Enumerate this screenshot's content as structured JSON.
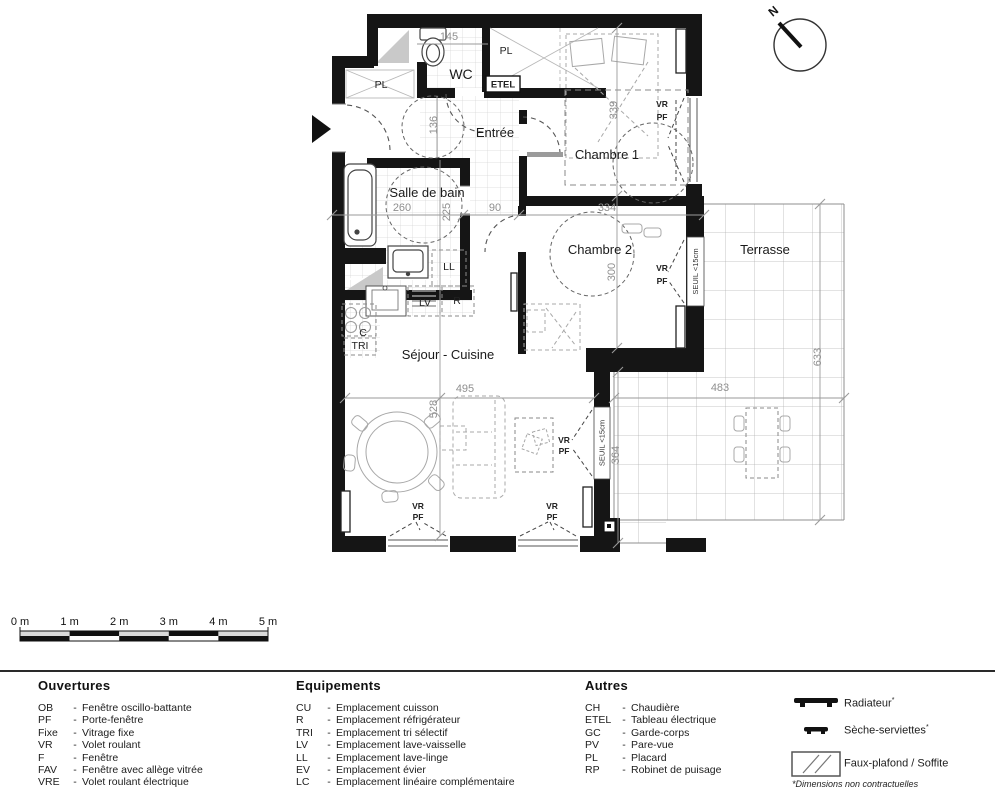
{
  "rooms": {
    "entree": "Entrée",
    "chambre1": "Chambre 1",
    "chambre2": "Chambre 2",
    "salle_de_bain": "Salle de bain",
    "wc": "WC",
    "sejour": "Séjour - Cuisine",
    "terrasse": "Terrasse"
  },
  "dims": {
    "wc_w": "145",
    "entree_w": "136",
    "bain_w": "260",
    "bain_h": "225",
    "hall_w": "90",
    "ch2_w": "334",
    "ch1_h": "339",
    "ch2_h": "300",
    "sejour_w": "495",
    "sejour_h": "528",
    "terrasse_low_w": "483",
    "terrasse_low_h": "364",
    "terrasse_h": "633"
  },
  "marks": {
    "north": "N",
    "pl": "PL",
    "etel": "ETEL",
    "ll": "LL",
    "lv": "LV",
    "r": "R",
    "c": "C",
    "tri": "TRI",
    "vr": "VR",
    "pf": "PF",
    "seuil": "SEUIL <15cm"
  },
  "scale": {
    "labels": [
      "0 m",
      "1 m",
      "2 m",
      "3 m",
      "4 m",
      "5 m"
    ]
  },
  "legend": {
    "sep": "-",
    "ouvertures": {
      "title": "Ouvertures",
      "items": [
        {
          "abbr": "OB",
          "label": "Fenêtre oscillo-battante"
        },
        {
          "abbr": "PF",
          "label": "Porte-fenêtre"
        },
        {
          "abbr": "Fixe",
          "label": "Vitrage fixe"
        },
        {
          "abbr": "VR",
          "label": "Volet roulant"
        },
        {
          "abbr": "F",
          "label": "Fenêtre"
        },
        {
          "abbr": "FAV",
          "label": "Fenêtre avec allège vitrée"
        },
        {
          "abbr": "VRE",
          "label": "Volet roulant électrique"
        }
      ]
    },
    "equipements": {
      "title": "Equipements",
      "items": [
        {
          "abbr": "CU",
          "label": "Emplacement cuisson"
        },
        {
          "abbr": "R",
          "label": "Emplacement réfrigérateur"
        },
        {
          "abbr": "TRI",
          "label": "Emplacement tri sélectif"
        },
        {
          "abbr": "LV",
          "label": "Emplacement lave-vaisselle"
        },
        {
          "abbr": "LL",
          "label": "Emplacement lave-linge"
        },
        {
          "abbr": "EV",
          "label": "Emplacement évier"
        },
        {
          "abbr": "LC",
          "label": "Emplacement linéaire complémentaire"
        }
      ]
    },
    "autres": {
      "title": "Autres",
      "items": [
        {
          "abbr": "CH",
          "label": "Chaudière"
        },
        {
          "abbr": "ETEL",
          "label": "Tableau électrique"
        },
        {
          "abbr": "GC",
          "label": "Garde-corps"
        },
        {
          "abbr": "PV",
          "label": "Pare-vue"
        },
        {
          "abbr": "PL",
          "label": "Placard"
        },
        {
          "abbr": "RP",
          "label": "Robinet de puisage"
        }
      ]
    },
    "symbols": [
      {
        "name": "radiateur",
        "label": "Radiateur",
        "mark": "*"
      },
      {
        "name": "seche-serviettes",
        "label": "Sèche-serviettes",
        "mark": "*"
      },
      {
        "name": "faux-plafond",
        "label": "Faux-plafond / Soffite",
        "mark": ""
      }
    ],
    "footnote": "*Dimensions non contractuelles"
  },
  "colors": {
    "wall": "#151515",
    "dim": "#8f8f8f",
    "grid": "#d2d2d2",
    "terrace_grid": "#b5b5b5",
    "furniture": "#9b9b9b",
    "shade": "#c9c9c9"
  }
}
